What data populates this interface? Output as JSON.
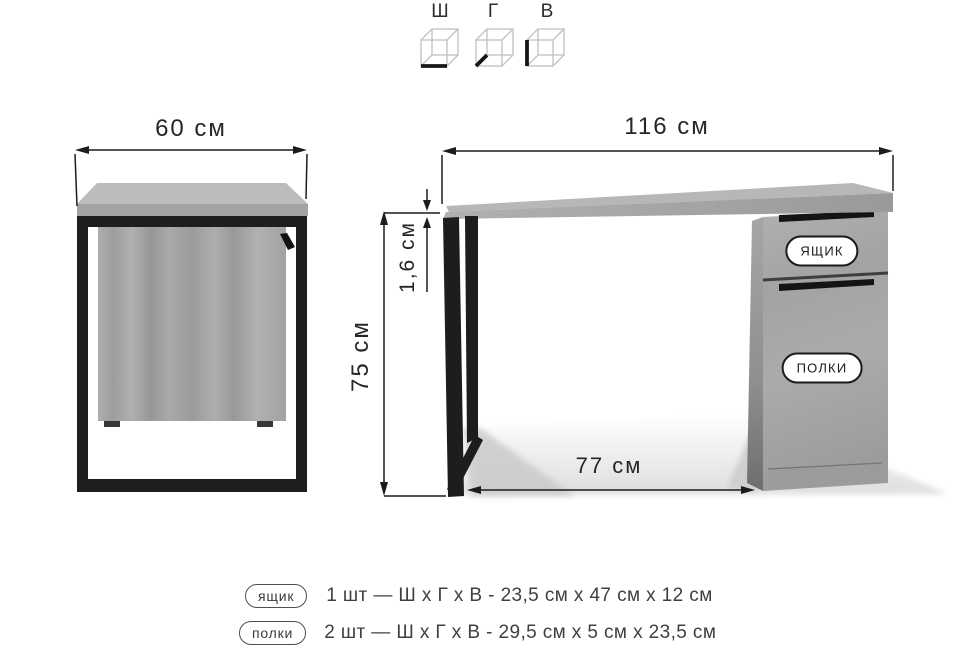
{
  "colors": {
    "background": "#ffffff",
    "ink": "#1c1c1c",
    "metal_black": "#1d1d1d",
    "wood_gray": "#a5a5a5"
  },
  "axis_key": {
    "items": [
      {
        "label": "Ш",
        "icon": "cube-width-icon"
      },
      {
        "label": "Г",
        "icon": "cube-depth-icon"
      },
      {
        "label": "В",
        "icon": "cube-height-icon"
      }
    ]
  },
  "side_view": {
    "width": "60 см"
  },
  "front_view": {
    "width": "116 см",
    "height": "75 см",
    "top_thickness": "1,6 см",
    "leg_opening": "77 см",
    "drawer_badge": "ЯЩИК",
    "shelves_badge": "ПОЛКИ"
  },
  "legend": {
    "rows": [
      {
        "badge": "ящик",
        "spec": "1 шт — Ш х Г х В - 23,5 см х 47 см х 12 см"
      },
      {
        "badge": "полки",
        "spec": "2 шт — Ш х Г х В - 29,5 см х 5 см х 23,5 см"
      }
    ]
  }
}
